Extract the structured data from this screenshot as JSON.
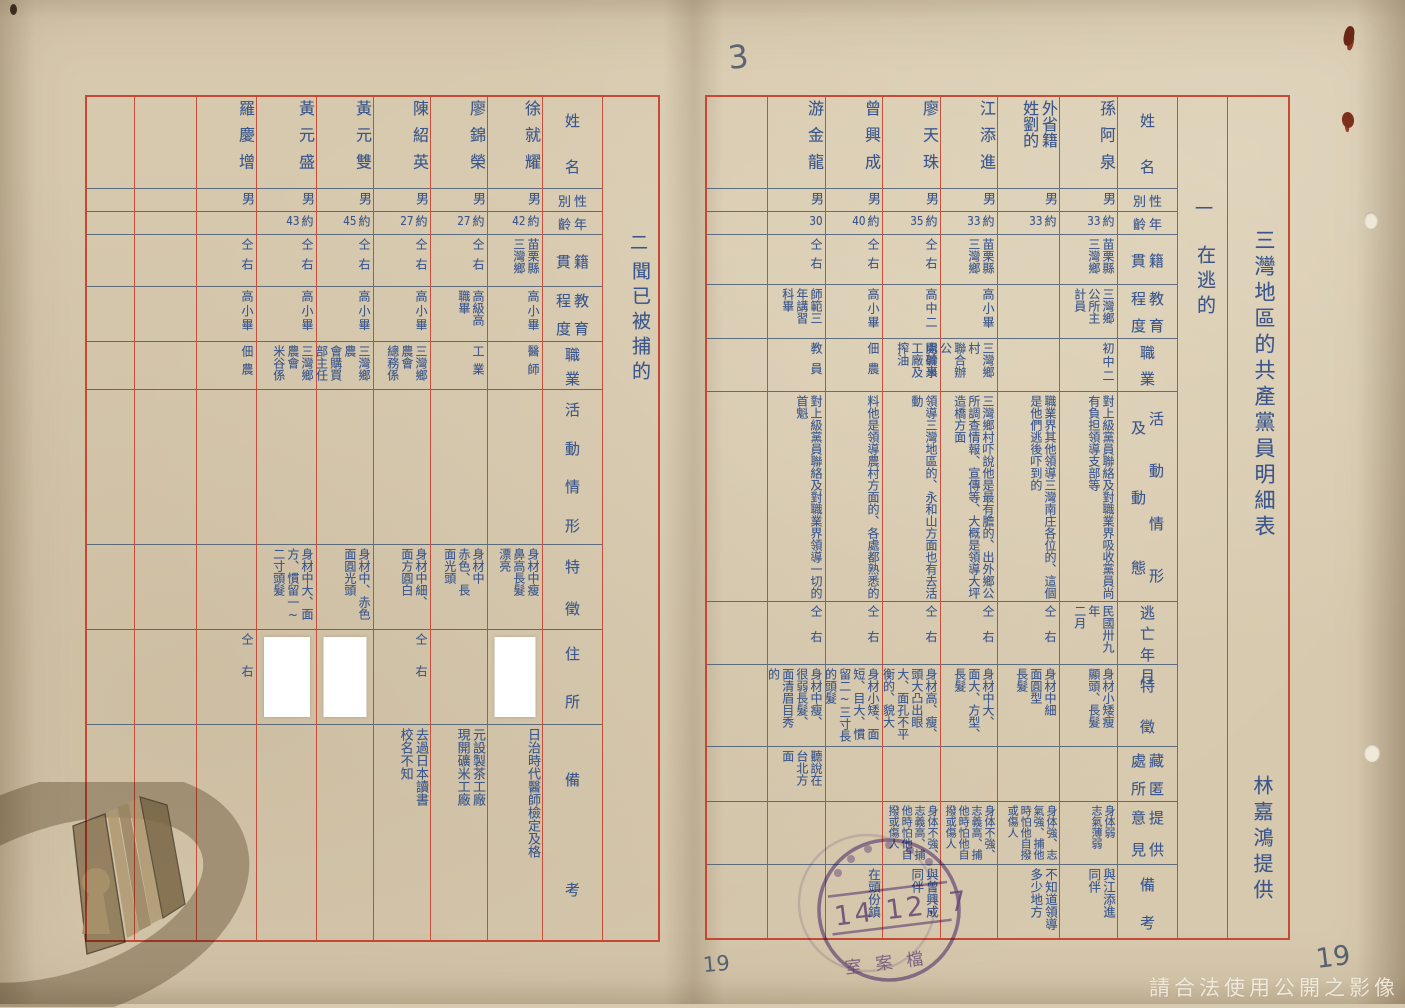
{
  "document": {
    "page_mark_top": "3",
    "page_number_left": "19",
    "page_number_right": "19",
    "watermark": "請合法使用公開之影像",
    "paper_color": "#d7c9ae",
    "grid_red": "#c43e2a",
    "ink_blue": "#3a568c",
    "stamp_purple": "#7d5fb0"
  },
  "right_page": {
    "title": "三灣地區的共產黨員明細表",
    "provider": "林嘉鴻提供",
    "section_number": "一",
    "section_label": "在逃的",
    "headers": [
      [
        "姓名"
      ],
      [
        "性",
        "別"
      ],
      [
        "年",
        "齡"
      ],
      [
        "籍",
        "貫"
      ],
      [
        "教育",
        "程度"
      ],
      [
        "職業"
      ],
      [
        "活動情形",
        "及動態"
      ],
      [
        "逃亡年月"
      ],
      [
        "特徵"
      ],
      [
        "藏匿",
        "處所"
      ],
      [
        "提供",
        "意見"
      ],
      [
        "備考"
      ]
    ],
    "rows": [
      {
        "cells": [
          "孫阿泉",
          "男",
          "約33",
          "苗栗縣\n三灣鄉",
          "三灣鄉\n公所主\n計員",
          "初中二",
          "對上級黨員聯絡及對職業界吸收黨員尚有負担領導支部等",
          "民國卅九年\n二月",
          "身材小矮瘦\n顯頭、長髮",
          "",
          "身体弱\n志氣薄弱",
          "與江添進\n同伴"
        ]
      },
      {
        "cells": [
          "外省籍\n姓劉的",
          "男",
          "約33",
          "",
          "",
          "",
          "職業界其他領導三灣南庄各位的、這個是他們逃後吓到的",
          "仝右",
          "身材中細\n面圓型\n長髮",
          "",
          "身体強、志氣強、捕他時怕他自撥或傷人",
          "不知道領導多少地方"
        ]
      },
      {
        "cells": [
          "江添進",
          "男",
          "約33",
          "苗栗縣\n三灣鄉",
          "高小畢",
          "三灣鄉村\n聯合辦公\n處幹事",
          "三灣鄉村吓說他是最有膽的、出外鄉公所調查情報、宣傳等、大概是領導大坪造橋方面",
          "仝右",
          "身材中大、\n面大、方型、\n長髮",
          "",
          "身体不強、志義高、捕他時怕他自撥或傷人",
          ""
        ]
      },
      {
        "cells": [
          "廖天珠",
          "男",
          "約35",
          "仝右",
          "高中二",
          "開礦米\n工廠及\n搾油",
          "領導三灣地區的、永和山方面也有去活動",
          "仝右",
          "身材高、瘦、頭大凸出眼大、面孔不平衡的、貌大",
          "",
          "身体不強、志義高、捕他時怕他自撥或傷人",
          "與曾興成\n同伴"
        ]
      },
      {
        "cells": [
          "曾興成",
          "男",
          "約40",
          "仝右",
          "高小畢",
          "佃農",
          "料他是領導農村方面的、各處都熟悉的",
          "仝右",
          "身材小矮、面短、目大、慣留二~三寸長的頭髮",
          "",
          "",
          "在頭份鎮"
        ]
      },
      {
        "cells": [
          "游金龍",
          "男",
          "30",
          "仝右",
          "師範三\n年講習\n科畢",
          "教員",
          "對上級黨員聯絡及對職業界領導一切的首魁",
          "仝右",
          "身材中瘦、\n很弱長髮、\n面清眉目秀\n的",
          "聽說在\n台北方\n面",
          "",
          ""
        ]
      }
    ],
    "stamp": {
      "date_line": "14 12. 7",
      "bottom_text": "室案檔"
    }
  },
  "left_page": {
    "section_number": "二",
    "section_label": "聞已被捕的",
    "headers": [
      [
        "姓名"
      ],
      [
        "性",
        "別"
      ],
      [
        "年",
        "齡"
      ],
      [
        "籍",
        "貫"
      ],
      [
        "教育",
        "程度"
      ],
      [
        "職業"
      ],
      [
        "活動情形"
      ],
      [
        "特徵"
      ],
      [
        "住所"
      ],
      [
        "備考"
      ]
    ],
    "rows": [
      {
        "cells": [
          "徐就耀",
          "男",
          "約42",
          "苗栗縣\n三灣鄉",
          "高小畢",
          "醫師",
          "",
          "身材中瘦\n鼻高長髮\n漂亮",
          "",
          "日治時代醫師檢定及格"
        ],
        "address_redacted": true
      },
      {
        "cells": [
          "廖錦榮",
          "男",
          "約27",
          "仝右",
          "高級高\n職畢",
          "工業",
          "",
          "身材中\n赤色、長\n面光頭",
          "",
          "元設製茶工廠\n現開礦米工廠"
        ],
        "address_redacted": false
      },
      {
        "cells": [
          "陳紹英",
          "男",
          "約27",
          "仝右",
          "高小畢",
          "三灣鄉農會\n總務係",
          "",
          "身材中細、\n面方圓白",
          "仝右",
          "去過日本讀書\n校名不知"
        ],
        "address_redacted": false
      },
      {
        "cells": [
          "黃元雙",
          "男",
          "約45",
          "仝右",
          "高小畢",
          "三灣鄉農\n會購買\n部主任",
          "",
          "身材中、赤色面圓光頭",
          "",
          ""
        ],
        "address_redacted": true
      },
      {
        "cells": [
          "黃元盛",
          "男",
          "約43",
          "仝右",
          "高小畢",
          "三灣鄉農會\n米谷係",
          "",
          "身材中大、面方、慣留一~二寸頭髮",
          "",
          ""
        ],
        "address_redacted": true
      },
      {
        "cells": [
          "羅慶增",
          "男",
          "",
          "仝右",
          "高小畢",
          "佃農",
          "",
          "",
          "仝右",
          ""
        ],
        "address_redacted": false
      }
    ]
  }
}
